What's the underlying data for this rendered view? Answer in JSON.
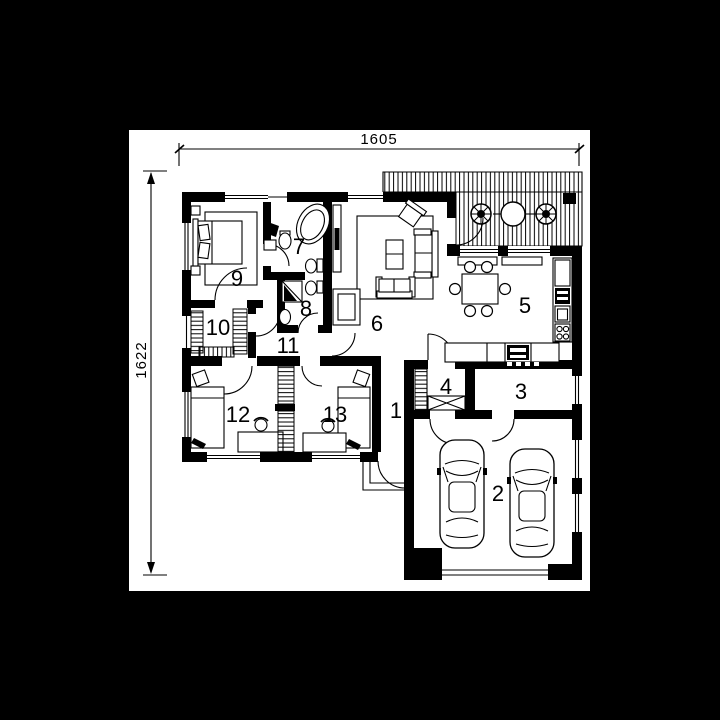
{
  "plan": {
    "dimension_top": "1605",
    "dimension_left": "1622",
    "rooms": [
      {
        "number": "1"
      },
      {
        "number": "2"
      },
      {
        "number": "3"
      },
      {
        "number": "4"
      },
      {
        "number": "5"
      },
      {
        "number": "6"
      },
      {
        "number": "7"
      },
      {
        "number": "8"
      },
      {
        "number": "9"
      },
      {
        "number": "10"
      },
      {
        "number": "11"
      },
      {
        "number": "12"
      },
      {
        "number": "13"
      }
    ],
    "colors": {
      "background": "#000000",
      "paper": "#ffffff",
      "ink": "#000000"
    }
  }
}
